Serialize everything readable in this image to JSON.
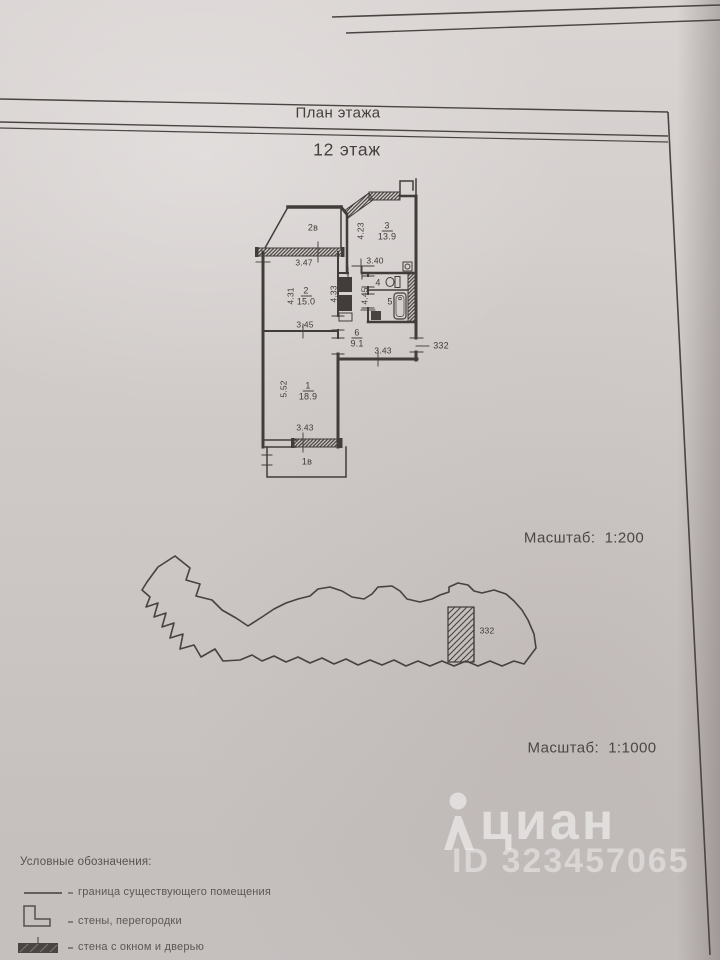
{
  "sheet": {
    "header_title": "План этажа",
    "floor_title": "12 этаж",
    "floor_scale": "Масштаб:  1:200",
    "site_scale": "Масштаб:  1:1000"
  },
  "plan": {
    "apartment_number": "332",
    "rooms": {
      "r1": {
        "num": "1",
        "area": "18.9"
      },
      "r2": {
        "num": "2",
        "area": "15.0"
      },
      "r3": {
        "num": "3",
        "area": "13.9"
      },
      "r4": {
        "num": "4"
      },
      "r5": {
        "num": "5"
      },
      "r6": {
        "num": "6",
        "area": "9.1"
      },
      "b1": {
        "num": "1в"
      },
      "b2": {
        "num": "2в"
      }
    },
    "dims": {
      "balcony2_width": "3.47",
      "room3_height": "4.23",
      "room3_width": "3.40",
      "room2_height_left": "4.31",
      "room2_height_right": "4.33",
      "room2_width": "3.45",
      "bath_height": "4.45",
      "hall_width": "3.43",
      "room1_height": "5.52",
      "room1_width": "3.43"
    },
    "fixtures": [
      "bathtub-icon",
      "toilet-icon",
      "washer-icon",
      "vent-icon"
    ]
  },
  "site": {
    "apartment_label": "332"
  },
  "watermark": {
    "brand": "циан",
    "listing_id": "ID 323457065",
    "icon_name": "cian-person-icon"
  },
  "legend": {
    "title": "Условные обозначения:",
    "items": [
      {
        "label": "граница существующего помещения"
      },
      {
        "label": "стены, перегородки"
      },
      {
        "label": "стена с окном и дверью"
      }
    ]
  }
}
